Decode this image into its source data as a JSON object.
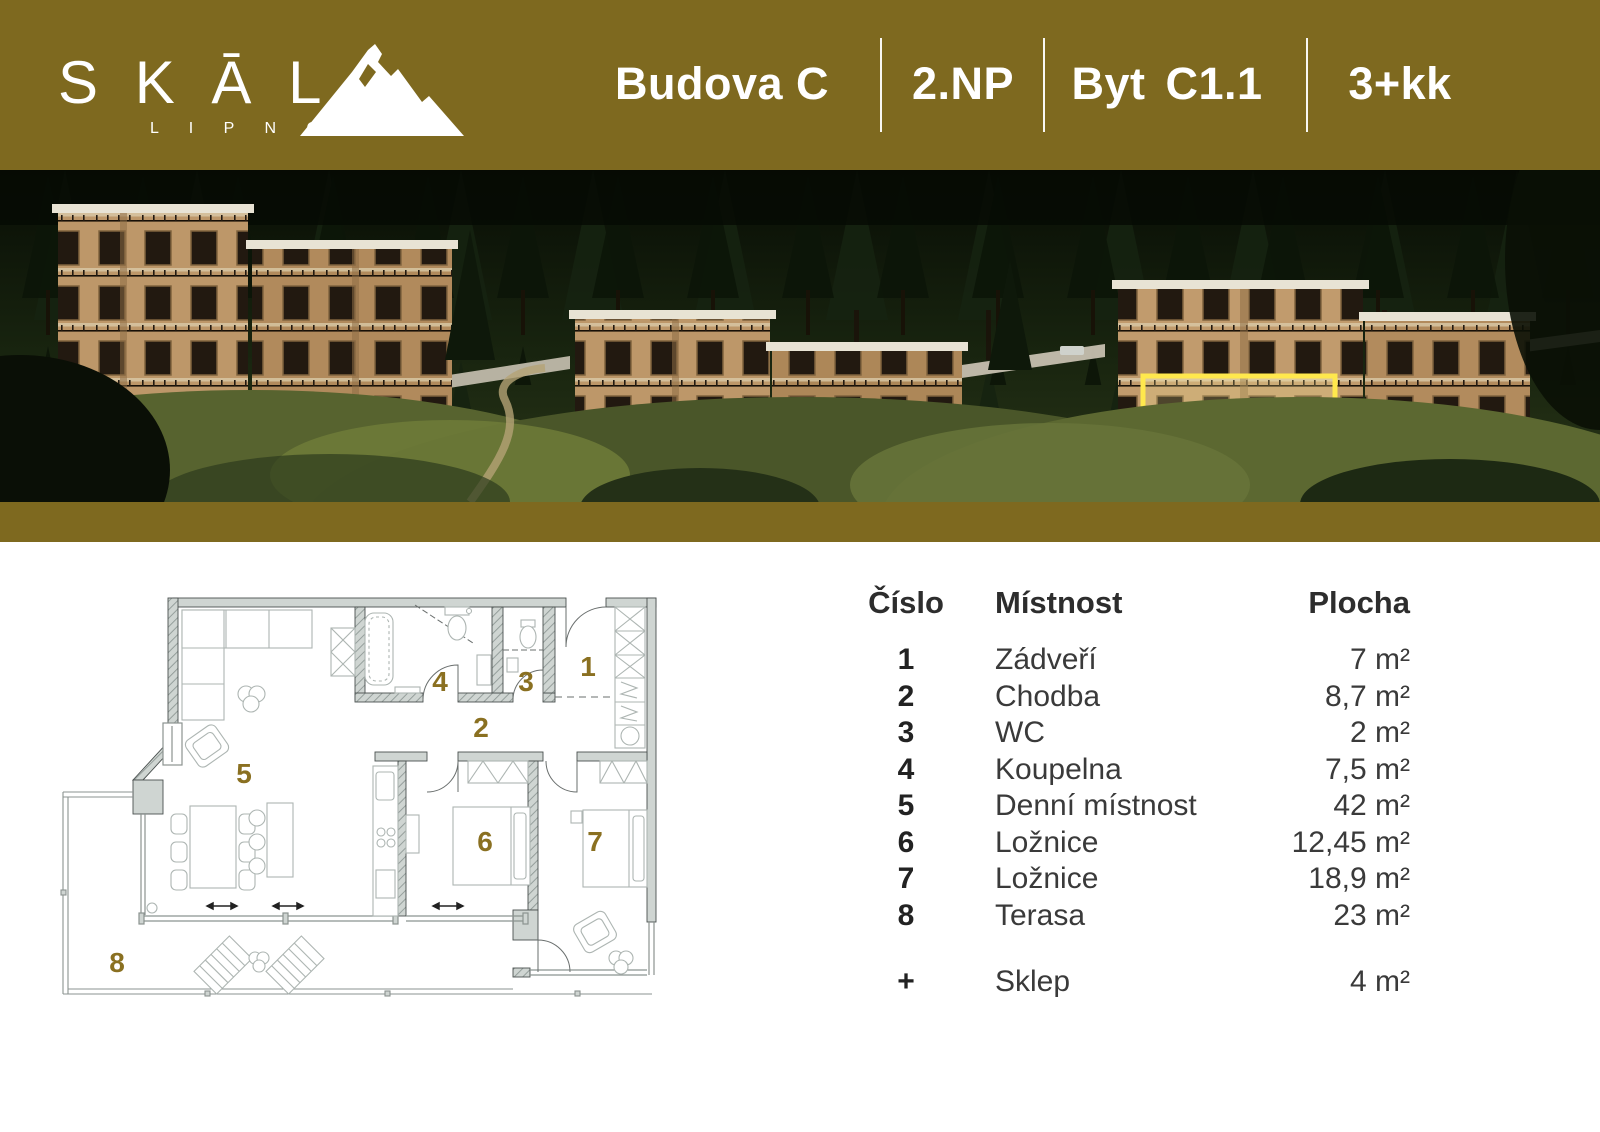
{
  "brand": {
    "letters": "S K Ā L",
    "sub": "L I P N O"
  },
  "title": {
    "building": "Budova C",
    "floor": "2.NP",
    "unit_prefix": "Byt",
    "unit": "C1.1",
    "disposition": "3+kk"
  },
  "table": {
    "col_number": "Číslo",
    "col_room": "Místnost",
    "col_area": "Plocha",
    "rows": [
      {
        "number": "1",
        "room": "Zádveří",
        "area": "7 m²"
      },
      {
        "number": "2",
        "room": "Chodba",
        "area": "8,7 m²"
      },
      {
        "number": "3",
        "room": "WC",
        "area": "2 m²"
      },
      {
        "number": "4",
        "room": "Koupelna",
        "area": "7,5 m²"
      },
      {
        "number": "5",
        "room": "Denní místnost",
        "area": "42 m²"
      },
      {
        "number": "6",
        "room": "Ložnice",
        "area": "12,45 m²"
      },
      {
        "number": "7",
        "room": "Ložnice",
        "area": "18,9 m²"
      },
      {
        "number": "8",
        "room": "Terasa",
        "area": "23 m²"
      }
    ],
    "extra_row": {
      "number": "+",
      "room": "Sklep",
      "area": "4 m²"
    }
  },
  "plan": {
    "room_labels": [
      {
        "n": "1"
      },
      {
        "n": "2"
      },
      {
        "n": "3"
      },
      {
        "n": "4"
      },
      {
        "n": "5"
      },
      {
        "n": "6"
      },
      {
        "n": "7"
      },
      {
        "n": "8"
      }
    ]
  },
  "colors": {
    "gold_band": "#7e691f",
    "label_gold": "#8a7021",
    "unit_highlight": "#ffe84d"
  }
}
